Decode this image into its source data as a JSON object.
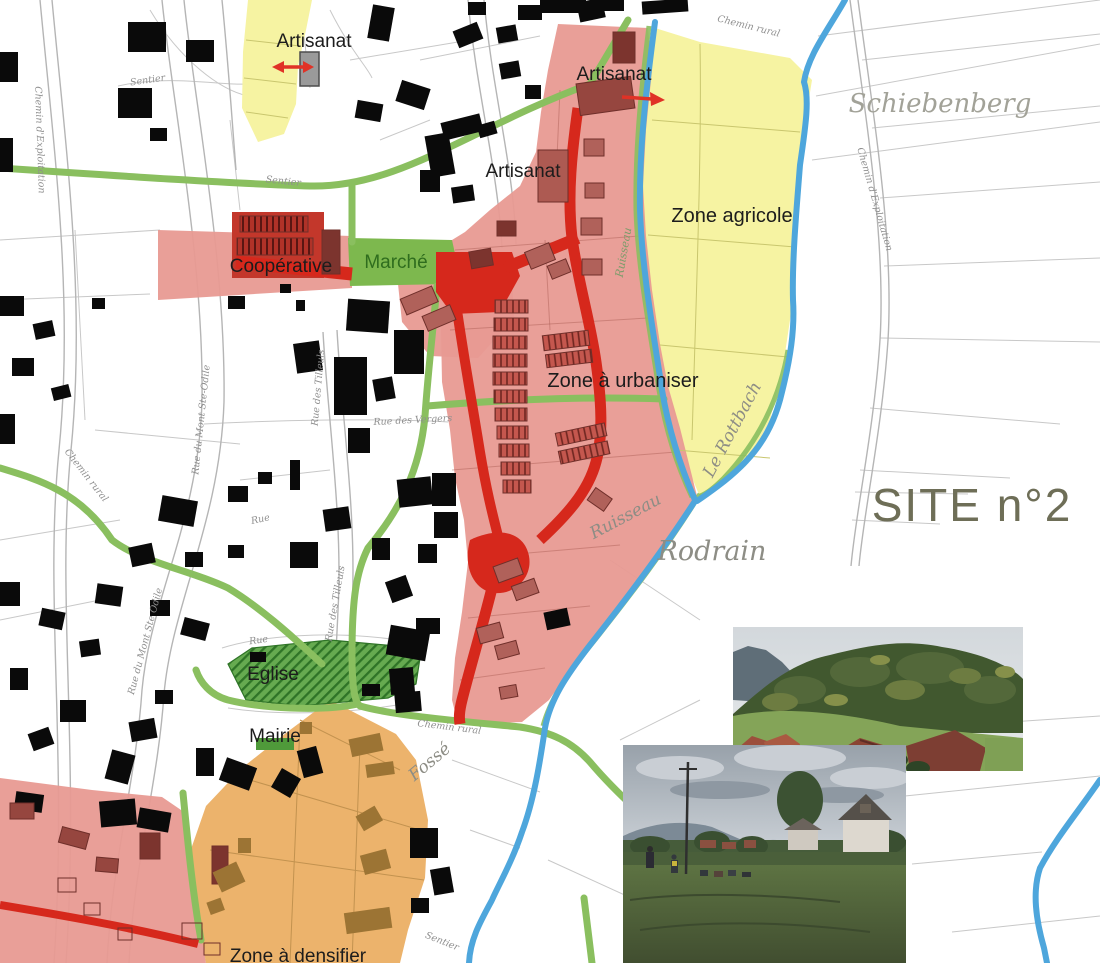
{
  "map": {
    "zone_labels": {
      "artisanat_nw": "Artisanat",
      "artisanat_n": "Artisanat",
      "artisanat_c": "Artisanat",
      "zone_agricole": "Zone agricole",
      "zone_a_urbaniser": "Zone à urbaniser",
      "zone_a_densifier": "Zone à densifier",
      "cooperative": "Coopérative",
      "marche": "Marché",
      "eglise": "Eglise",
      "mairie": "Mairie"
    },
    "place_labels": {
      "site": "SITE n°2",
      "schiebenberg": "Schiebenberg",
      "rodrain": "Rodrain"
    },
    "waterway_labels": {
      "rottbach": "Le Rottbach",
      "ruisseau_lower": "Ruisseau",
      "ruisseau_upper": "Ruisseau",
      "fosse": "Fossé"
    },
    "street_labels": {
      "chemin_rural_top": "Chemin rural",
      "chemin_rural_west": "Chemin rural",
      "chemin_rural_south": "Chemin rural",
      "chemin_exploitation_left": "Chemin d'Exploitation",
      "chemin_exploitation_right": "Chemin d'Exploitation",
      "sentier_nw": "Sentier",
      "sentier_mid": "Sentier",
      "sentier_south": "Sentier",
      "rue_mont_ste_odile_upper": "Rue du Mont Ste-Odile",
      "rue_mont_ste_odile_lower": "Rue du Mont Ste Odile",
      "rue_des_tilleuls_upper": "Rue des Tilleuls",
      "rue_des_tilleuls_lower": "Rue des Tilleuls",
      "rue_des_vergers": "Rue des Vergers",
      "rue_1": "Rue",
      "rue_2": "Rue"
    },
    "colors": {
      "zone_urbaniser_pink": "#e89a92",
      "zone_agricole_yellow": "#f6f3a2",
      "zone_densifier_orange": "#ecb36c",
      "proposed_building_red": "#96463f",
      "existing_building_black": "#0a0a0a",
      "new_road_red": "#d6281c",
      "green_path": "#8abf5f",
      "stream_blue": "#4ea6dc",
      "public_green": "#4f9a3a",
      "site_label_olive": "#6e6e57"
    }
  },
  "photos": [
    {
      "name": "hillside-village-photo",
      "description": "wooded hillside above village rooftops"
    },
    {
      "name": "meadow-village-photo",
      "description": "group standing in a meadow in front of village houses"
    }
  ]
}
